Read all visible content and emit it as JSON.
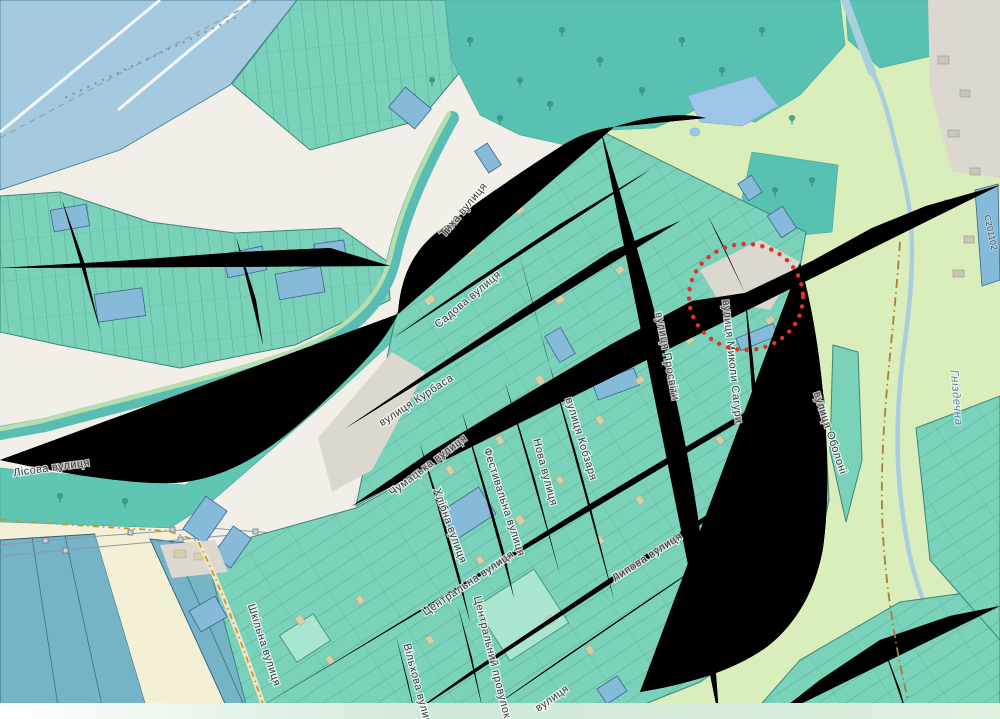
{
  "map": {
    "description": "OpenStreetMap-style map of a village street grid with allotment parcels, farmland fields, a river and a red dotted highlight circle",
    "marker": {
      "type": "red-dotted-circle",
      "cx": 746,
      "cy": 297,
      "rx": 57,
      "ry": 53
    },
    "street_labels": [
      {
        "id": "tykha",
        "text": "Тиха вулиця",
        "x": 466,
        "y": 212,
        "r": -50
      },
      {
        "id": "sadova",
        "text": "Садова вулиця",
        "x": 470,
        "y": 302,
        "r": -40
      },
      {
        "id": "kurbasa",
        "text": "вулиця Курбаса",
        "x": 418,
        "y": 403,
        "r": -33
      },
      {
        "id": "chumatska",
        "text": "Чумацька вулиця",
        "x": 430,
        "y": 468,
        "r": -37
      },
      {
        "id": "lisova",
        "text": "Лісова вулиця",
        "x": 52,
        "y": 471,
        "r": -8
      },
      {
        "id": "prosvity",
        "text": "вулиця Просвіти",
        "x": 664,
        "y": 357,
        "r": 79
      },
      {
        "id": "sahury",
        "text": "вулиця Миколи Сагури",
        "x": 729,
        "y": 362,
        "r": 84
      },
      {
        "id": "oboloni",
        "text": "вулиця Оболоні",
        "x": 827,
        "y": 434,
        "r": 72
      },
      {
        "id": "kobzarya",
        "text": "вулиця Кобзаря",
        "x": 578,
        "y": 440,
        "r": 73
      },
      {
        "id": "nova",
        "text": "Нова вулиця",
        "x": 542,
        "y": 473,
        "r": 75
      },
      {
        "id": "festyvalna",
        "text": "Фестивальна вулиця",
        "x": 501,
        "y": 503,
        "r": 72
      },
      {
        "id": "khlibna",
        "text": "Хлібна вулиця",
        "x": 447,
        "y": 527,
        "r": 70
      },
      {
        "id": "tsentralna",
        "text": "Центральна вулиця",
        "x": 470,
        "y": 586,
        "r": -34
      },
      {
        "id": "lypova",
        "text": "Липова вулиця",
        "x": 649,
        "y": 560,
        "r": -33
      },
      {
        "id": "tsentralnyi-provulok",
        "text": "Центральний провулок",
        "x": 489,
        "y": 658,
        "r": 76
      },
      {
        "id": "shkilna",
        "text": "Шкільна вулиця",
        "x": 261,
        "y": 646,
        "r": 72
      },
      {
        "id": "vilkhova",
        "text": "Вільхова вулиця",
        "x": 415,
        "y": 688,
        "r": 75
      },
      {
        "id": "bottom-partial",
        "text": "вулиця",
        "x": 554,
        "y": 701,
        "r": -35
      }
    ],
    "water_labels": [
      {
        "id": "hnizdechna",
        "text": "Гніздечна",
        "x": 953,
        "y": 398,
        "r": 85
      }
    ],
    "ref_labels": [
      {
        "id": "road-ref",
        "text": "С201102",
        "x": 988,
        "y": 233,
        "r": 78
      }
    ],
    "colors": {
      "base": "#f2efe9",
      "grass": "#daeebb",
      "farmland": "#f3f0d6",
      "forest": "#58c1b1",
      "orchard": "#5fc6b4",
      "parcel": "#79d2b9",
      "parcel-blue": "#85bbd9",
      "field-blue": "#a5cadf",
      "field-blue-dark": "#74b4c6",
      "water": "#9ec6e8",
      "stream": "#a8cfe0",
      "road-fill": "#ffffff",
      "road-casing": "#c6c2ba",
      "label": "#3a3a3a",
      "water-label": "#5a7fae",
      "circle-red": "#e23327"
    }
  }
}
